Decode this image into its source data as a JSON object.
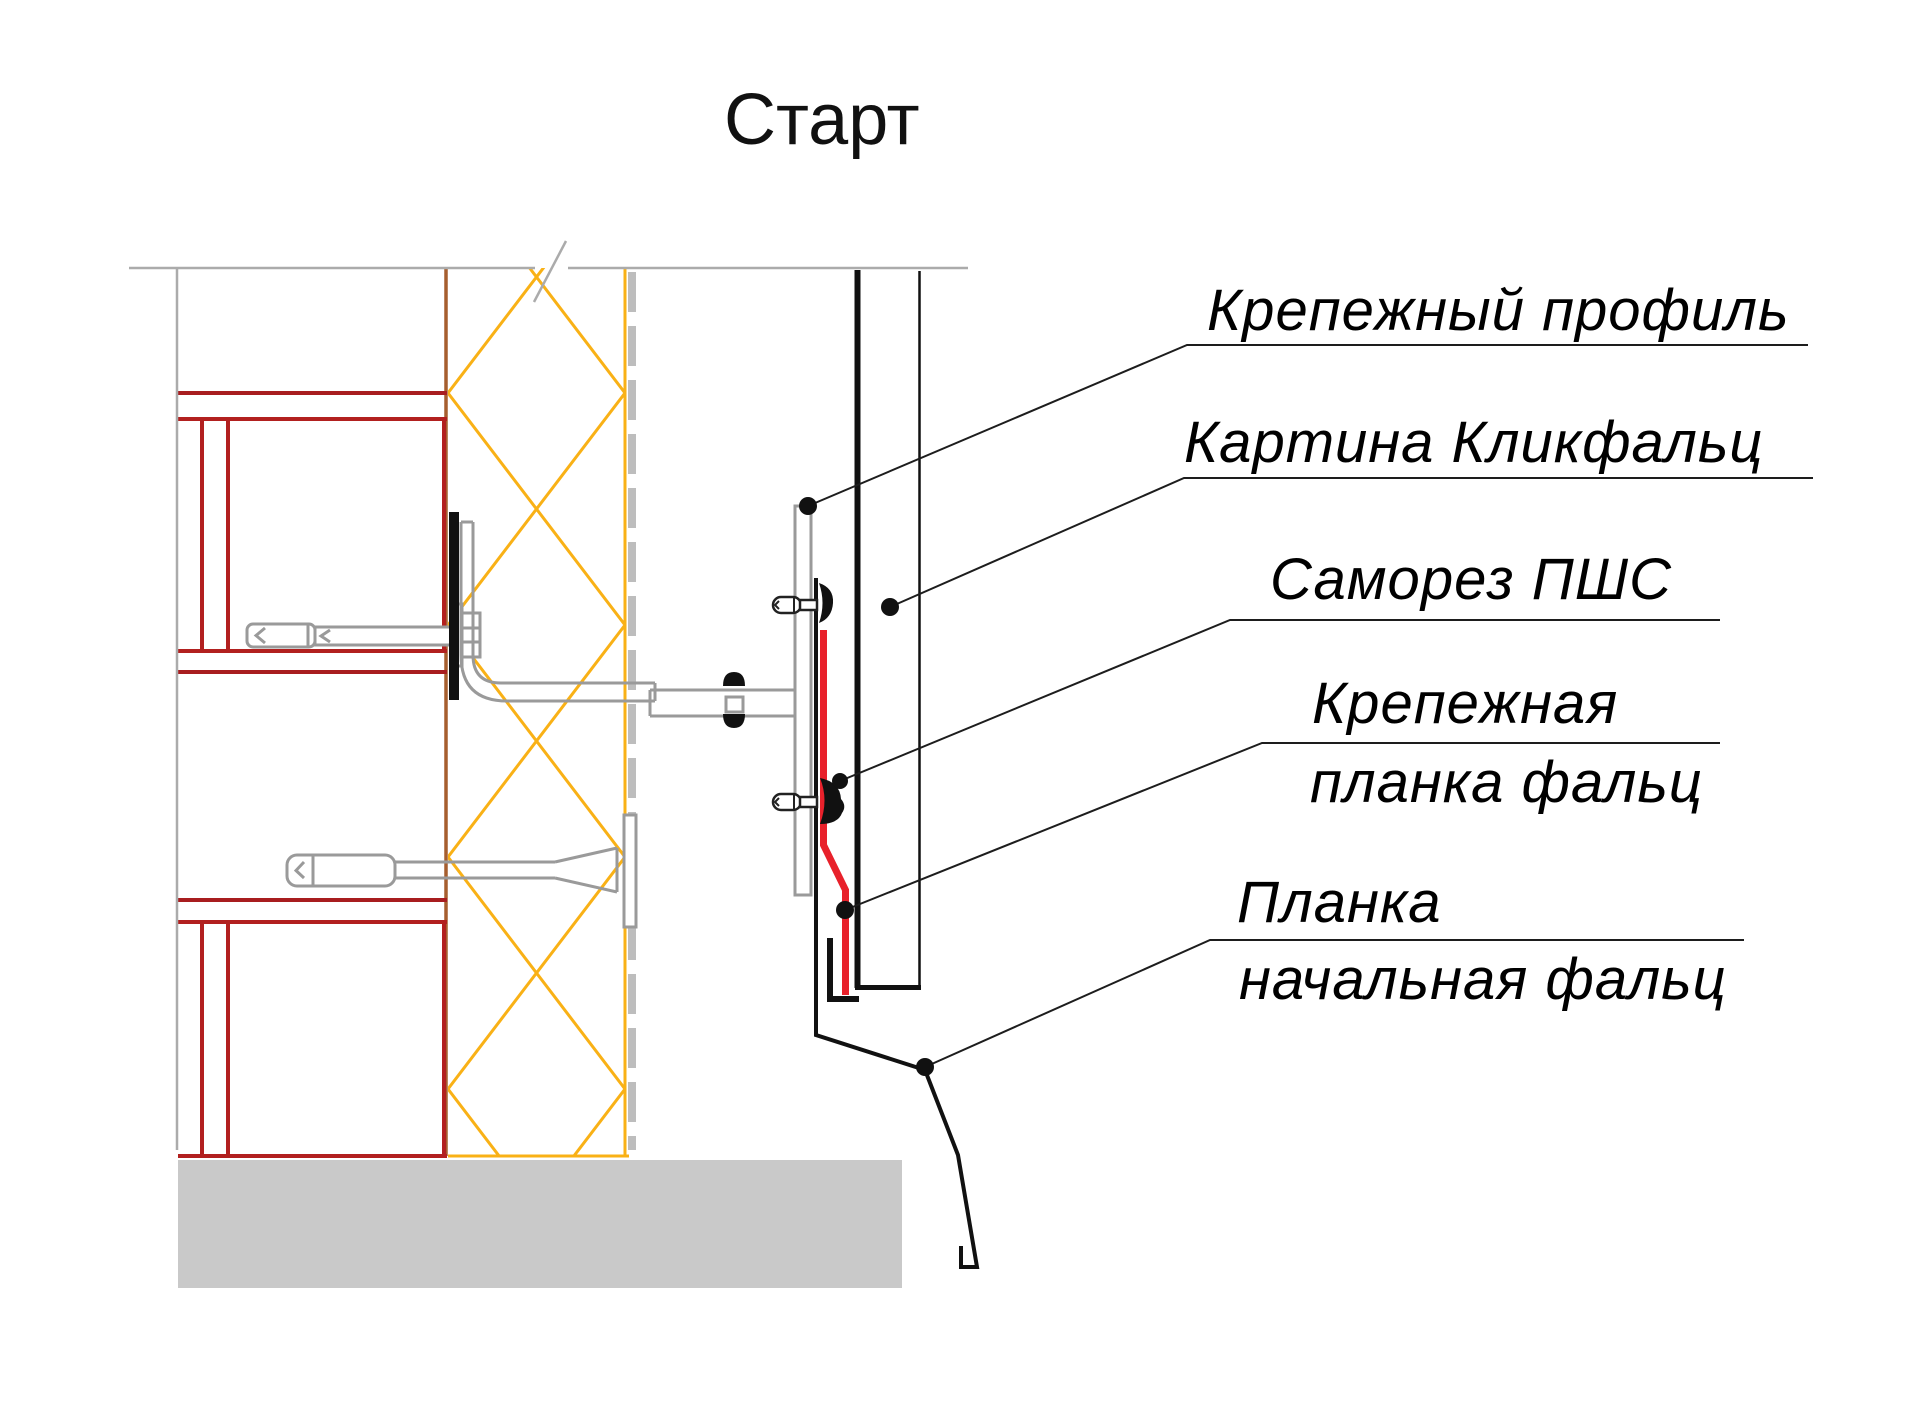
{
  "title": "Старт",
  "labels": {
    "fastening_profile": {
      "line1": "Крепежный профиль"
    },
    "klickfalz_panel": {
      "line1": "Картина Кликфальц"
    },
    "screw_pshs": {
      "line1": "Саморез ПШС"
    },
    "fastening_strip": {
      "line1": "Крепежная",
      "line2": "планка фальц"
    },
    "starting_strip": {
      "line1": "Планка",
      "line2": "начальная фальц"
    }
  },
  "colors": {
    "framing_red": "#A81D1F",
    "wall_face_brown": "#A65E2E",
    "insulation_yellow": "#F9B116",
    "membrane_gray": "#BDBDBD",
    "metal_gray": "#9A9A9A",
    "panel_black": "#111111",
    "clamp_strip_red": "#E8212B",
    "concrete_gray": "#C9C9C9"
  }
}
